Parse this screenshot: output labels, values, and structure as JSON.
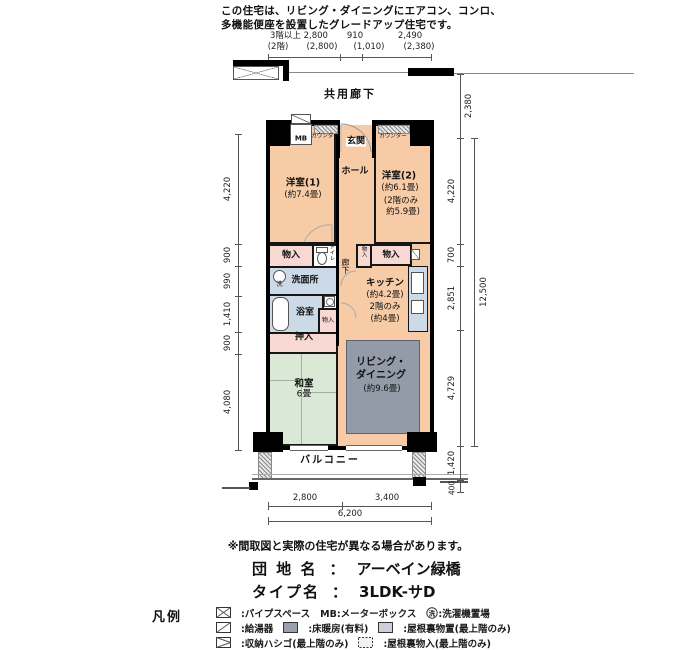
{
  "colors": {
    "room_orange": "#f6cba5",
    "closet_pink": "#f7d8d3",
    "wet_blue": "#ccd9e6",
    "tatami_green": "#d9e9d5",
    "carpet_gray": "#939aa8",
    "wall_black": "#000000"
  },
  "header": {
    "line1": "この住宅は、リビング・ダイニングにエアコン、コンロ、",
    "line2": "多機能便座を設置したグレードアップ住宅です。"
  },
  "top_dims": {
    "r1c1": "3階以上 2,800",
    "r1c2": "910",
    "r1c3": "2,490",
    "r2c1": "(2階)",
    "r2c2": "(2,800)",
    "r2c3": "(1,010)",
    "r2c4": "(2,380)"
  },
  "labels": {
    "corridor": "共用廊下",
    "balcony": "バルコニー"
  },
  "rooms": {
    "mb": "MB",
    "counter_left": "カウンター",
    "counter_right": "カウンター",
    "genkan": "玄関",
    "hall": "ホール",
    "bed1_name": "洋室(1)",
    "bed1_size": "(約7.4畳)",
    "bed2_name": "洋室(2)",
    "bed2_size": "(約6.1畳)",
    "bed2_note1": "(2階のみ",
    "bed2_note2": "約5.9畳)",
    "storage1": "物入",
    "toilet": "トイレ",
    "washroom": "洗面所",
    "wash_mark": "洗",
    "bath": "浴室",
    "storage2": "物入",
    "corridor": "廊下",
    "storage3": "物入",
    "storage4": "物入",
    "kitchen_name": "キッチン",
    "kitchen_size": "(約4.2畳)",
    "kitchen_note1": "2階のみ",
    "kitchen_note2": "(約4畳)",
    "oshiire": "押入",
    "washitsu_name": "和室",
    "washitsu_size": "6畳",
    "living1": "リビング・",
    "living2": "ダイニング",
    "living_size": "(約9.6畳)"
  },
  "left_dims": {
    "d1": "4,220",
    "d2": "900",
    "d3": "990",
    "d4": "1,410",
    "d5": "900",
    "d6": "4,080"
  },
  "right_dims": {
    "top": "2,380",
    "d1": "4,220",
    "d2": "700",
    "d3": "2,851",
    "total": "12,500",
    "d4": "4,729",
    "balcony": "1,420",
    "edge": "400"
  },
  "bottom_dims": {
    "d1": "2,800",
    "d2": "3,400",
    "total": "6,200"
  },
  "footer": {
    "note": "※間取図と実際の住宅が異なる場合があります。",
    "estate_label": "団 地 名",
    "estate_sep": "：",
    "estate_value": "アーベイン緑橋",
    "type_label": "タイプ名",
    "type_sep": "：",
    "type_value": "3LDK-サD"
  },
  "legend": {
    "title": "凡例",
    "pipe_space": ":パイプスペース",
    "meter_box": "MB:メーターボックス",
    "wash_mark": "洗",
    "washing_machine": ":洗濯機置場",
    "water_heater": ":給湯器",
    "floor_heating": ":床暖房(有料)",
    "attic_storage": ":屋根裏物置(最上階のみ)",
    "ladder": ":収納ハシゴ(最上階のみ)",
    "attic_closet": ":屋根裏物入(最上階のみ)"
  }
}
